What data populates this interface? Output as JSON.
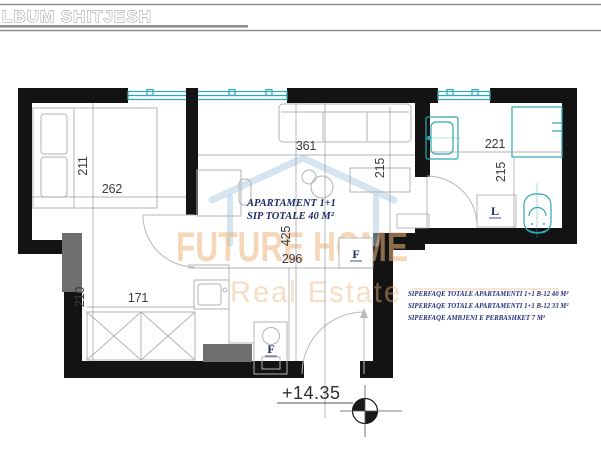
{
  "header": {
    "title": "LBUM SHITJESH"
  },
  "plan": {
    "unit_label": {
      "line1": "APARTAMENT 1+1",
      "line2": "SIP TOTALE  40 M²"
    },
    "level_marker": "+14.35",
    "markers": {
      "radiator": "F",
      "kitchen": "F",
      "washer": "L"
    },
    "dims": {
      "bedroom_w": "262",
      "bedroom_h": "211",
      "living_w_top": "361",
      "living_h_right": "215",
      "living_h": "425",
      "living_w": "296",
      "corridor_h": "210",
      "corridor_w": "171",
      "bath_w": "221",
      "bath_h": "215"
    },
    "notes": [
      "SIPERFAQE TOTALE APARTAMENTI 1+1 B-12  40 M²",
      "SIPERFAQE TOTALE APARTAMENTI 1+1 B-12  33 M²",
      "SIPERFAQE AMBJENI E PERBASHKET  7 M²"
    ],
    "watermark": {
      "brand": "FUTURE HOME",
      "tagline": "Real Estate"
    },
    "colors": {
      "wall": "#131313",
      "fixture": "#2fa8b5",
      "navy": "#1c2b66",
      "dim_text": "#3c3c3c",
      "watermark_orange": "#edb57e",
      "watermark_blue": "#a9c9e2",
      "shaft_gray": "#6f6f6f"
    }
  }
}
